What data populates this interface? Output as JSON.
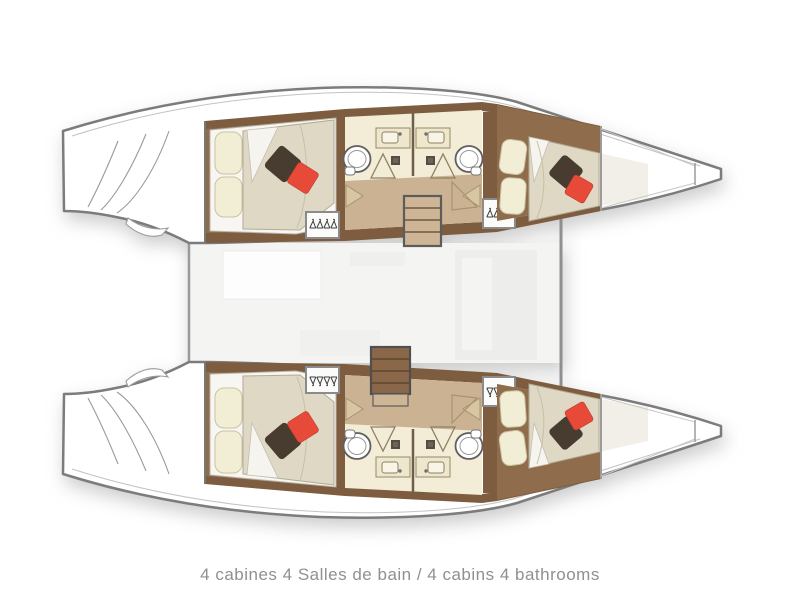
{
  "caption": {
    "text": "4 cabines 4 Salles de bain / 4 cabins 4 bathrooms"
  },
  "plan": {
    "type": "catamaran-lower-deck-floorplan",
    "cabins_count": 4,
    "bathrooms_count": 4,
    "icons": {
      "toilet": "toilet-icon",
      "sink": "sink-icon",
      "shower_door": "shower-door-icon",
      "hanger": "hanger-icon",
      "stairs": "stairs-icon",
      "stern_steps": "stern-steps-icon",
      "cushion_dark": "dark-cushion-icon",
      "cushion_red": "red-cushion-icon"
    },
    "colors": {
      "hull_outline": "#7c7c7c",
      "wood_dark": "#7d5c3f",
      "wood_floor": "#8f6c4c",
      "mattress": "#ded8c4",
      "pillow": "#f2eed6",
      "cushion_dark": "#483c31",
      "cushion_red": "#e74a39",
      "bathroom_floor": "#f3ecd6",
      "corridor_floor": "#cbb292",
      "stairs": "#cdb595",
      "bridgedeck": "#f4f4f2",
      "caption_text": "#909090"
    }
  }
}
